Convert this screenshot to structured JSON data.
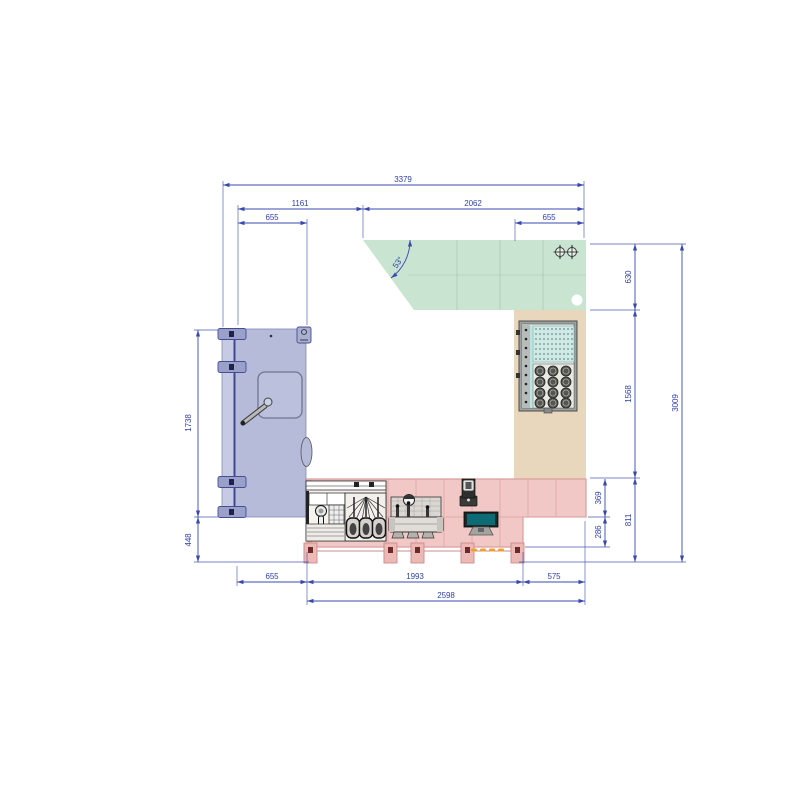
{
  "title": "Kitchen layout CAD plan",
  "colors": {
    "dimension_blue": "#3a49b0",
    "zone_green": "#c9e4d0",
    "zone_beige": "#e9d7bd",
    "zone_pink": "#f2c8c6",
    "door_lavender": "#b5bbd9",
    "pos_screen_teal": "#0d6b75",
    "accent_orange": "#f0a030"
  },
  "dimensions": {
    "top": {
      "overall": "3379",
      "left_span": "1161",
      "right_span": "2062",
      "left_sub": "655",
      "right_sub": "655"
    },
    "left": {
      "door_height": "1738",
      "below_door": "448"
    },
    "right": {
      "upper": "630",
      "middle": "1568",
      "lower": "811",
      "counter_upper": "369",
      "counter_lower": "286",
      "overall": "3009"
    },
    "bottom": {
      "left_offset": "655",
      "counter_span": "1993",
      "right_span": "575",
      "counter_overall": "2598"
    },
    "angle": "53°"
  },
  "icons": [
    {
      "name": "center-mark-icon",
      "meaning": "registration / center mark",
      "glyph": "circle-cross"
    },
    {
      "name": "column-marker",
      "meaning": "round column marker",
      "glyph": "white-circle"
    }
  ]
}
